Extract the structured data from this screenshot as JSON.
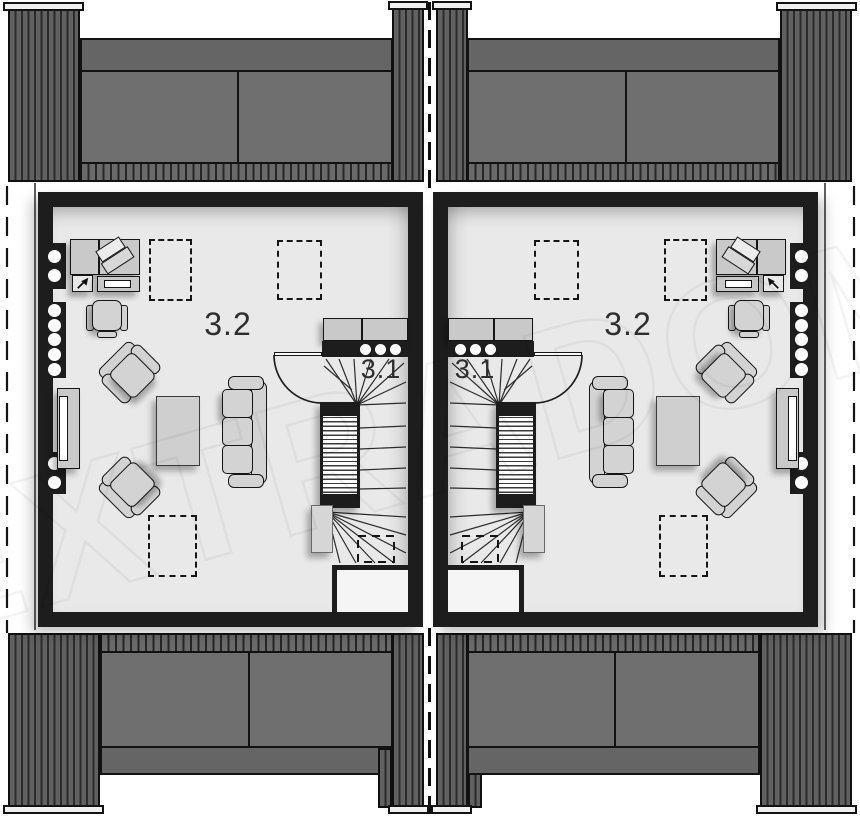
{
  "units": {
    "left": {
      "room_label": "3.2",
      "stair_label": "3.1"
    },
    "right": {
      "room_label": "3.2",
      "stair_label": "3.1"
    }
  },
  "watermark": {
    "text": "EXTRADOM"
  },
  "icons": [
    "cursor-arrow-icon"
  ],
  "colors": {
    "wall": "#1d1d1d",
    "floor": "#e9e9e9",
    "closet": "#f5f5f5",
    "furniture": "#cfcfcf",
    "label": "#2e2e2e",
    "roof_panel": "#6f6f6f",
    "roof_band": "#656565",
    "roof_stripe_dark": "#262626"
  }
}
